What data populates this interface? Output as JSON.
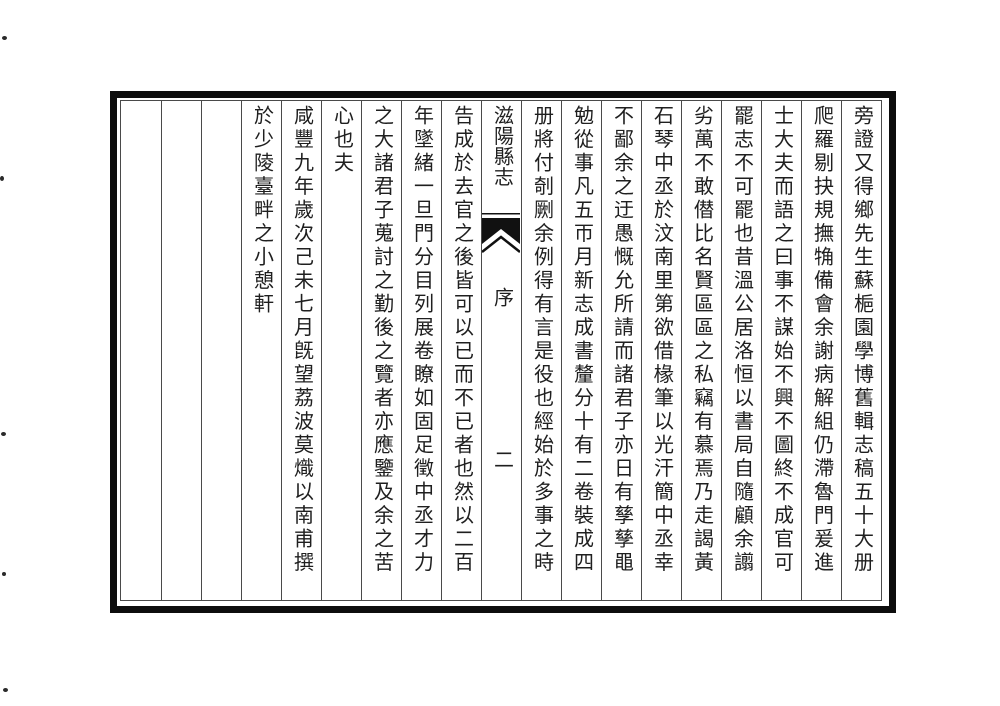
{
  "book": {
    "title": "滋陽縣志",
    "section": "序",
    "page_number": "二",
    "columns_right": [
      "旁證又得鄉先生蘇梔園學博舊輯志稿五十大册",
      "爬羅剔抉規撫觕備會余謝病解組仍滯魯門爰進",
      "士大夫而語之曰事不謀始不興不圖終不成官可",
      "罷志不可罷也昔溫公居洛恒以書局自隨顧余譾",
      "劣萬不敢僣比名賢區區之私竊有慕焉乃走謁黃",
      "石琴中丞於汶南里第欲借椽筆以光汗簡中丞幸",
      "不鄙余之迂愚慨允所請而諸君子亦日有孳孳黽",
      "勉從事凡五帀月新志成書釐分十有二卷裝成四",
      "册將付剞劂余例得有言是役也經始於多事之時"
    ],
    "columns_left": [
      "告成於去官之後皆可以已而不已者也然以二百",
      "年墜緒一旦門分目列展卷瞭如固足徵中丞才力",
      "之大諸君子蒐討之勤後之覽者亦應鑒及余之苦",
      "心也夫",
      "咸豐九年歲次己未七月旣望荔波莫熾以南甫撰",
      "於少陵臺畔之小憩軒"
    ],
    "empty_columns": 3,
    "colors": {
      "ink": "#1f1f1f",
      "outer_border": "#0d0d0d",
      "rule_lines": "#4a4a4a",
      "paper": "#ffffff"
    }
  }
}
